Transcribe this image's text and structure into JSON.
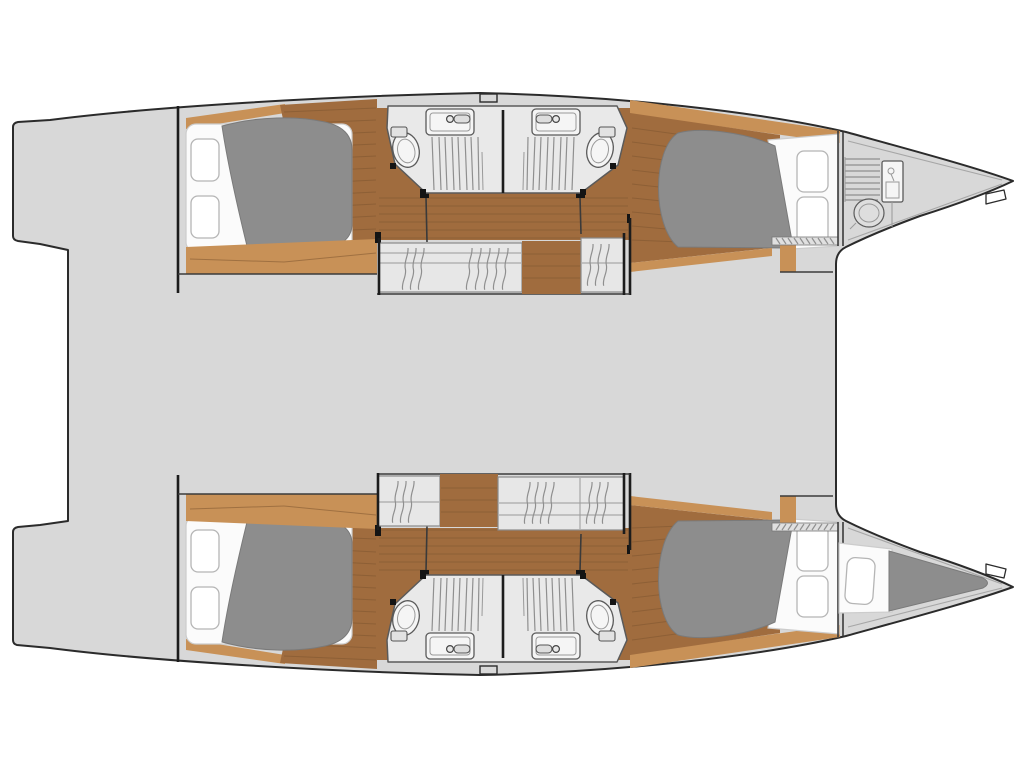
{
  "meta": {
    "description": "Catamaran yacht interior deck plan, plan view, bows pointing right, no text labels",
    "canvas": {
      "width": 1024,
      "height": 768
    }
  },
  "colors": {
    "background": "#ffffff",
    "outline": "#2b2b2b",
    "deck": "#d8d8d8",
    "wood_light": "#c89157",
    "wood_dark": "#a06c3e",
    "plank": "#7d5530",
    "mattress": "#8d8d8d",
    "linen": "#fbfbfb",
    "pillow_line": "#b5b5b5",
    "bathroom": "#e9e9e9",
    "fixture": "#f5f5f5",
    "fixture_line": "#5a5a5a",
    "steps": "#e7e7e7",
    "steps_line": "#9a9a9a",
    "hatch": "#8f8f8f",
    "divider": "#1c1c1c",
    "boundary": "#3a3a3a",
    "toe_line": "#a6a6a6"
  },
  "vessel": {
    "type": "catamaran",
    "view": "overhead floor plan",
    "orientation": "bows to the right, stern platforms to the left",
    "hulls": [
      "port (top)",
      "starboard (bottom)"
    ],
    "bridge_deck": "open gray deck between hulls, no furniture drawn"
  },
  "rooms_per_hull": [
    {
      "name": "aft-cabin",
      "fixtures": [
        "double berth with gray duvet",
        "2 pillows",
        "wood floor"
      ]
    },
    {
      "name": "bathroom-aft",
      "fixtures": [
        "toilet",
        "sink with faucet",
        "slatted shower floor"
      ]
    },
    {
      "name": "bathroom-forward",
      "fixtures": [
        "toilet",
        "sink with faucet",
        "slatted shower floor"
      ]
    },
    {
      "name": "companionway-steps",
      "count": 2
    },
    {
      "name": "forward-cabin",
      "fixtures": [
        "double berth with gray duvet",
        "2 pillows",
        "wood floor",
        "louvered locker strip"
      ]
    },
    {
      "name": "forepeak",
      "port_contents": [
        "slatted rack",
        "locker cabinet",
        "round container"
      ],
      "starboard_contents": [
        "crew berth cushion",
        "small pillow"
      ]
    }
  ],
  "deck_features": [
    "stern swim platforms",
    "midship cleat notch on each sheer line",
    "bow toe-rail lines",
    "anchor step notch near each bow tip"
  ]
}
